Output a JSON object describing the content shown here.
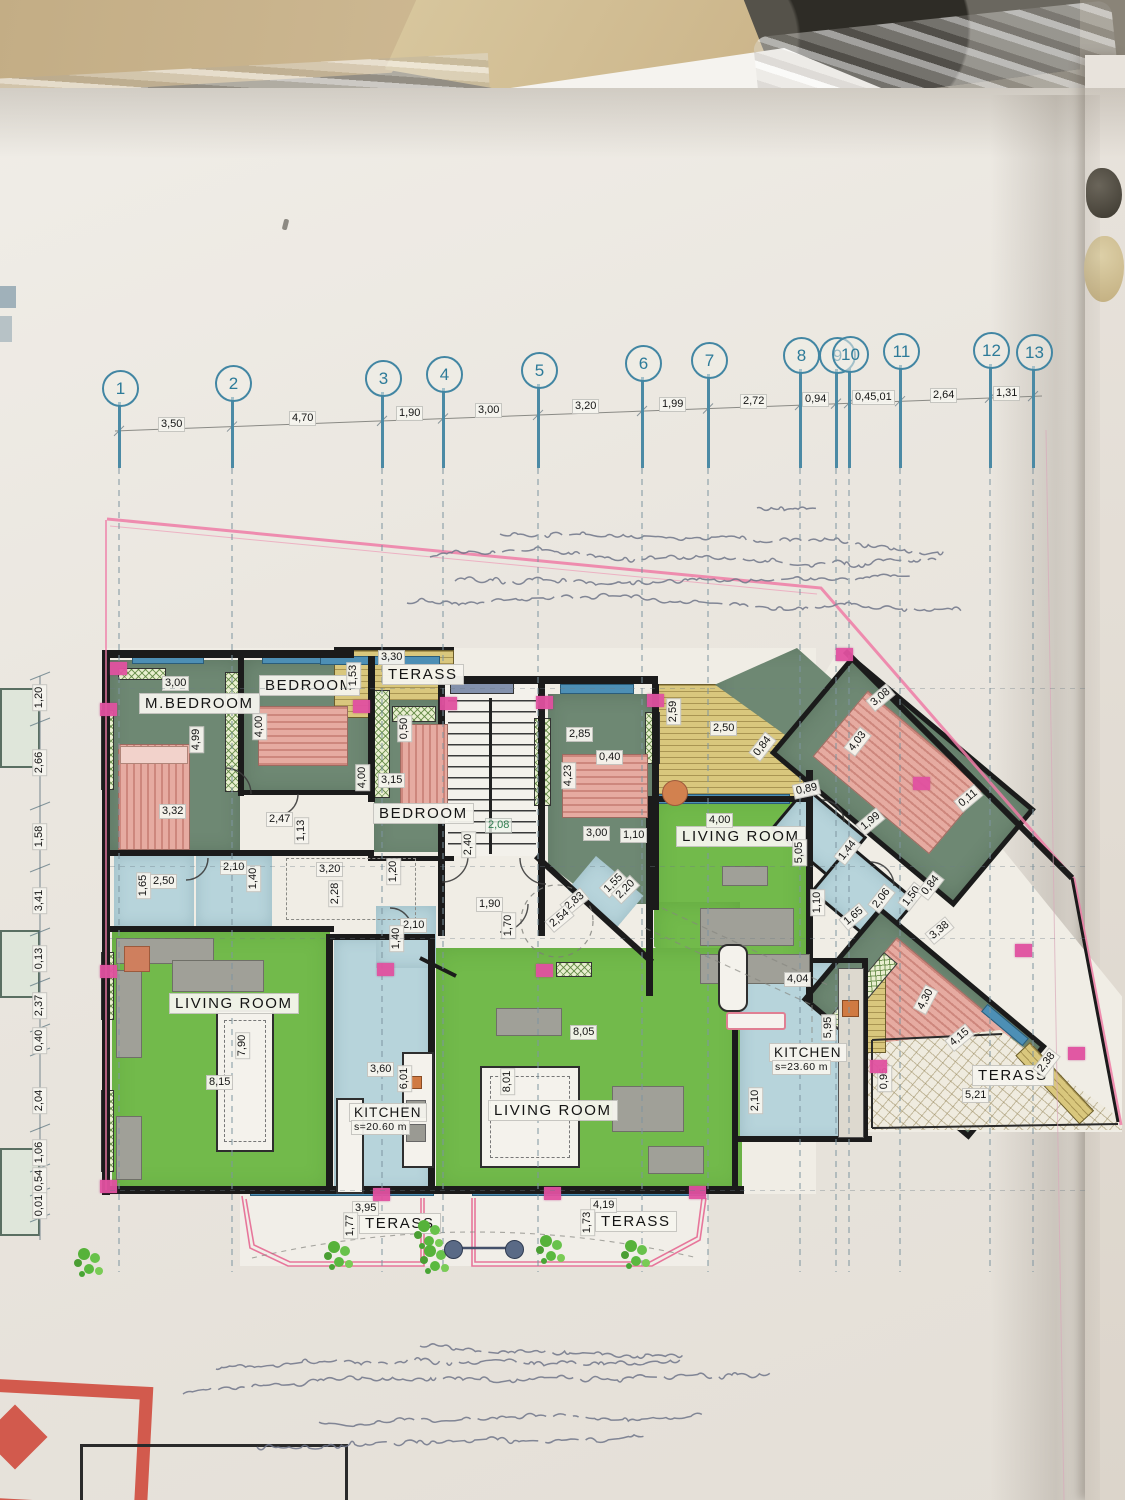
{
  "palette": {
    "living_green": "#72ba4b",
    "bedroom_sage": "#6e8873",
    "kitchen_blue": "#b7d4db",
    "terrace_yellow": "#d9c77d",
    "marker_magenta": "#e151a0",
    "boundary_pink": "#ef7ba6",
    "grid_teal": "#2d7b99",
    "wall_black": "#1b1b1b",
    "bed_salmon": "#e6aba1",
    "paper": "#eae6df",
    "stamp_red": "#d25a4d"
  },
  "grid": {
    "circles": [
      {
        "n": "1",
        "x": 119,
        "y": 387
      },
      {
        "n": "2",
        "x": 232,
        "y": 382
      },
      {
        "n": "3",
        "x": 382,
        "y": 377
      },
      {
        "n": "4",
        "x": 443,
        "y": 373
      },
      {
        "n": "5",
        "x": 538,
        "y": 369
      },
      {
        "n": "6",
        "x": 642,
        "y": 362
      },
      {
        "n": "7",
        "x": 708,
        "y": 359
      },
      {
        "n": "8",
        "x": 800,
        "y": 354
      },
      {
        "n": "9",
        "x": 836,
        "y": 354
      },
      {
        "n": "10",
        "x": 849,
        "y": 353
      },
      {
        "n": "11",
        "x": 900,
        "y": 350
      },
      {
        "n": "12",
        "x": 990,
        "y": 349
      },
      {
        "n": "13",
        "x": 1033,
        "y": 351
      }
    ],
    "dims": [
      {
        "t": "3,50",
        "x": 172,
        "y": 424
      },
      {
        "t": "4,70",
        "x": 303,
        "y": 418
      },
      {
        "t": "1,90",
        "x": 410,
        "y": 413
      },
      {
        "t": "3,00",
        "x": 489,
        "y": 410
      },
      {
        "t": "3,20",
        "x": 586,
        "y": 406
      },
      {
        "t": "1,99",
        "x": 673,
        "y": 404
      },
      {
        "t": "2,72",
        "x": 754,
        "y": 401
      },
      {
        "t": "0,94",
        "x": 816,
        "y": 399
      },
      {
        "t": "0,45,01",
        "x": 866,
        "y": 397
      },
      {
        "t": "2,64",
        "x": 944,
        "y": 395
      },
      {
        "t": "1,31",
        "x": 1007,
        "y": 393
      }
    ]
  },
  "left_chain": {
    "x": 34,
    "dims": [
      {
        "t": "1,20",
        "y": 697
      },
      {
        "t": "2,66",
        "y": 762
      },
      {
        "t": "1,58",
        "y": 836
      },
      {
        "t": "3,41",
        "y": 900
      },
      {
        "t": "0,13",
        "y": 958
      },
      {
        "t": "2,37",
        "y": 1005
      },
      {
        "t": "0,40",
        "y": 1040
      },
      {
        "t": "2,04",
        "y": 1100
      },
      {
        "t": "1,06",
        "y": 1152
      },
      {
        "t": "0,54",
        "y": 1180
      },
      {
        "t": "0,01",
        "y": 1205
      }
    ],
    "ticks": [
      676,
      722,
      806,
      868,
      932,
      982,
      1028,
      1052,
      1128,
      1168,
      1192,
      1218
    ]
  },
  "labels": [
    [
      "M.BEDROOM",
      139,
      700,
      0,
      "r"
    ],
    [
      "BEDROOM",
      259,
      682,
      0,
      "r"
    ],
    [
      "TERASS",
      382,
      671,
      0,
      "r"
    ],
    [
      "BEDROOM",
      373,
      810,
      0,
      "r"
    ],
    [
      "LIVING ROOM",
      676,
      833,
      0,
      "r"
    ],
    [
      "LIVING ROOM",
      169,
      1000,
      0,
      "r"
    ],
    [
      "LIVING ROOM",
      488,
      1107,
      0,
      "r"
    ],
    [
      "KITCHEN",
      349,
      1110,
      0,
      "r2"
    ],
    [
      "s=20.60 m",
      351,
      1127,
      0,
      "s"
    ],
    [
      "KITCHEN",
      769,
      1050,
      0,
      "r2"
    ],
    [
      "s=23.60 m",
      772,
      1067,
      0,
      "s"
    ],
    [
      "TERASS",
      972,
      1072,
      0,
      "r"
    ],
    [
      "TERASS",
      359,
      1220,
      0,
      "r"
    ],
    [
      "TERASS",
      595,
      1218,
      0,
      "r"
    ],
    [
      "3,00",
      162,
      683,
      0,
      "d"
    ],
    [
      "4,99",
      183,
      739,
      -90,
      "d"
    ],
    [
      "3,32",
      159,
      811,
      0,
      "d"
    ],
    [
      "4,00",
      246,
      726,
      -90,
      "d"
    ],
    [
      "3,30",
      378,
      657,
      0,
      "d"
    ],
    [
      "1,53",
      340,
      675,
      -90,
      "d"
    ],
    [
      "0,50",
      391,
      728,
      -90,
      "d"
    ],
    [
      "4,00",
      349,
      777,
      -90,
      "d"
    ],
    [
      "3,15",
      378,
      780,
      0,
      "d"
    ],
    [
      "2,47",
      266,
      819,
      0,
      "d"
    ],
    [
      "1,13",
      288,
      830,
      -90,
      "d"
    ],
    [
      "2,40",
      455,
      844,
      -90,
      "d"
    ],
    [
      "2,08",
      485,
      825,
      0,
      "t"
    ],
    [
      "2,85",
      566,
      734,
      0,
      "d"
    ],
    [
      "0,40",
      596,
      757,
      0,
      "d"
    ],
    [
      "4,23",
      555,
      775,
      -90,
      "d"
    ],
    [
      "3,00",
      583,
      833,
      0,
      "d"
    ],
    [
      "1,10",
      620,
      835,
      0,
      "d"
    ],
    [
      "2,59",
      660,
      711,
      -90,
      "d"
    ],
    [
      "2,50",
      710,
      728,
      0,
      "d"
    ],
    [
      "0,84",
      749,
      746,
      -52,
      "d"
    ],
    [
      "4,00",
      706,
      820,
      0,
      "d"
    ],
    [
      "5,05",
      786,
      852,
      -90,
      "d"
    ],
    [
      "3,08",
      867,
      697,
      -40,
      "d"
    ],
    [
      "4,03",
      844,
      741,
      -52,
      "d"
    ],
    [
      "0,89",
      793,
      789,
      -12,
      "d"
    ],
    [
      "1,99",
      857,
      821,
      -40,
      "d"
    ],
    [
      "1,44",
      834,
      850,
      -52,
      "d"
    ],
    [
      "0,11",
      955,
      798,
      -40,
      "d"
    ],
    [
      "2,06",
      868,
      898,
      -52,
      "d"
    ],
    [
      "1,65",
      840,
      916,
      -40,
      "d"
    ],
    [
      "1,50",
      898,
      896,
      -52,
      "d"
    ],
    [
      "0,84",
      917,
      885,
      -52,
      "d"
    ],
    [
      "1,10",
      804,
      902,
      -90,
      "d"
    ],
    [
      "3,38",
      926,
      930,
      -40,
      "d"
    ],
    [
      "4,30",
      912,
      999,
      -62,
      "d"
    ],
    [
      "4,15",
      946,
      1037,
      -40,
      "d"
    ],
    [
      "5,21",
      962,
      1095,
      0,
      "d"
    ],
    [
      "2,38",
      1033,
      1062,
      -52,
      "d"
    ],
    [
      "0,95",
      871,
      1078,
      -90,
      "d"
    ],
    [
      "4,04",
      784,
      979,
      0,
      "d"
    ],
    [
      "5,95",
      815,
      1027,
      -90,
      "d"
    ],
    [
      "2,10",
      742,
      1100,
      -90,
      "d"
    ],
    [
      "1,65",
      130,
      885,
      -90,
      "d"
    ],
    [
      "2,50",
      150,
      881,
      0,
      "d"
    ],
    [
      "2,10",
      220,
      867,
      0,
      "d"
    ],
    [
      "1,40",
      240,
      878,
      -90,
      "d"
    ],
    [
      "3,20",
      316,
      869,
      0,
      "d"
    ],
    [
      "2,28",
      322,
      893,
      -90,
      "d"
    ],
    [
      "1,20",
      380,
      871,
      -90,
      "d"
    ],
    [
      "2,10",
      400,
      925,
      0,
      "d"
    ],
    [
      "1,40",
      383,
      938,
      -90,
      "d"
    ],
    [
      "1,90",
      476,
      904,
      0,
      "d"
    ],
    [
      "1,70",
      495,
      925,
      -90,
      "d"
    ],
    [
      "2,83",
      561,
      901,
      -40,
      "d"
    ],
    [
      "2,54",
      546,
      918,
      -40,
      "d"
    ],
    [
      "1,55",
      600,
      883,
      -45,
      "d"
    ],
    [
      "2,20",
      612,
      889,
      -45,
      "d"
    ],
    [
      "7,90",
      229,
      1045,
      -90,
      "d"
    ],
    [
      "8,15",
      206,
      1082,
      0,
      "d"
    ],
    [
      "3,60",
      367,
      1069,
      0,
      "d"
    ],
    [
      "6,01",
      391,
      1078,
      -90,
      "d"
    ],
    [
      "8,01",
      494,
      1081,
      -90,
      "d"
    ],
    [
      "8,05",
      570,
      1032,
      0,
      "d"
    ],
    [
      "3,95",
      352,
      1208,
      0,
      "d"
    ],
    [
      "1,77",
      337,
      1225,
      -90,
      "d"
    ],
    [
      "4,19",
      590,
      1205,
      0,
      "d"
    ],
    [
      "1,73",
      574,
      1222,
      -90,
      "d"
    ]
  ],
  "markers": [
    [
      110,
      662
    ],
    [
      100,
      703
    ],
    [
      353,
      700
    ],
    [
      440,
      697
    ],
    [
      536,
      696
    ],
    [
      647,
      694
    ],
    [
      836,
      648
    ],
    [
      913,
      777
    ],
    [
      1015,
      944
    ],
    [
      1068,
      1047
    ],
    [
      870,
      1060
    ],
    [
      536,
      964
    ],
    [
      377,
      963
    ],
    [
      100,
      965
    ],
    [
      373,
      1188
    ],
    [
      544,
      1187
    ],
    [
      100,
      1180
    ],
    [
      689,
      1186
    ]
  ],
  "plants": [
    [
      328,
      1241
    ],
    [
      418,
      1220
    ],
    [
      424,
      1245
    ],
    [
      540,
      1235
    ],
    [
      625,
      1240
    ],
    [
      78,
      1248
    ]
  ],
  "columns": [
    [
      452,
      1248
    ],
    [
      513,
      1248
    ]
  ],
  "handwriting": {
    "top": [
      [
        757,
        508,
        55
      ],
      [
        500,
        534,
        440
      ],
      [
        430,
        557,
        500
      ],
      [
        448,
        581,
        450
      ],
      [
        407,
        603,
        548
      ]
    ],
    "bottom": [
      [
        420,
        1346,
        258
      ],
      [
        216,
        1369,
        462
      ],
      [
        183,
        1394,
        585
      ],
      [
        312,
        1421,
        390
      ],
      [
        257,
        1447,
        383
      ]
    ]
  }
}
